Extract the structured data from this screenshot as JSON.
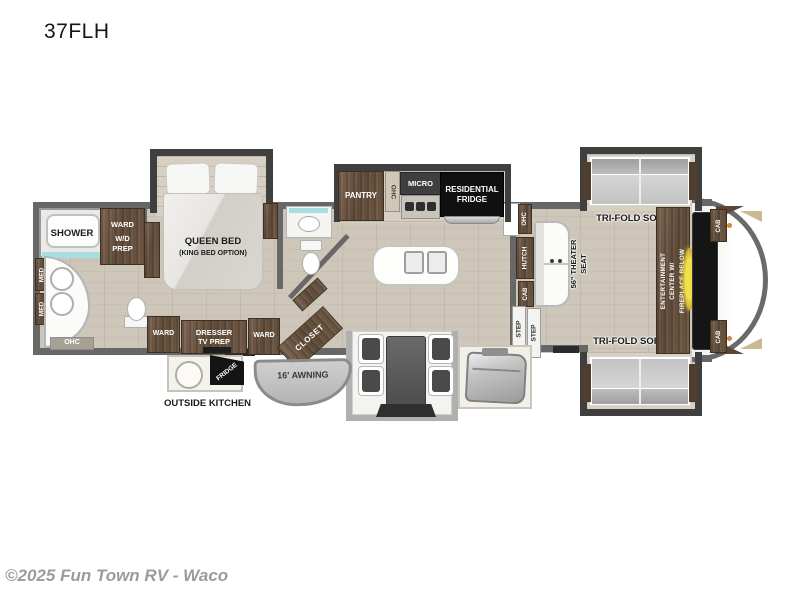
{
  "meta": {
    "title": "37FLH",
    "copyright": "©2025 Fun Town RV - Waco"
  },
  "palette": {
    "floor": "#cdc6b9",
    "wall": "#676767",
    "slide_wall": "#3f3f3f",
    "wood": "#6d5743",
    "accent_teal": "#a8dde2",
    "fireplace_glow": "#eedf4b",
    "cap_dot_orange": "#d2863a",
    "fridge_black": "#111111"
  },
  "bathroom": {
    "shower": "SHOWER",
    "ward": "WARD",
    "wd_line1": "W/D",
    "wd_line2": "PREP",
    "med_1": "MED",
    "med_2": "MED",
    "ohc": "OHC"
  },
  "bedroom": {
    "bed_line1": "QUEEN BED",
    "bed_line2": "(KING BED OPTION)",
    "ward_left": "WARD",
    "dresser_line1": "DRESSER",
    "dresser_line2": "TV PREP",
    "ward_right": "WARD"
  },
  "midbath": {
    "closet": "CLOSET"
  },
  "kitchen": {
    "pantry": "PANTRY",
    "ohc": "OHC",
    "micro": "MICRO",
    "fridge_line1": "RESIDENTIAL",
    "fridge_line2": "FRIDGE"
  },
  "exterior": {
    "outside_kitchen": "OUTSIDE KITCHEN",
    "fridge": "FRIDGE",
    "awning": "16' AWNING"
  },
  "living": {
    "ohc": "OHC",
    "hutch": "HUTCH",
    "cab": "CAB",
    "theater_line1": "56\" THEATER",
    "theater_line2": "SEAT",
    "step_1": "STEP",
    "step_2": "STEP",
    "sofa_top_label": "TRI-FOLD SOFA",
    "sofa_bottom_label": "TRI-FOLD SOFA",
    "ent_line1": "ENTERTAINMENT",
    "ent_line2": "CENTER W/",
    "ent_line3": "FIREPLACE BELOW",
    "cab_rear_top": "CAB",
    "cab_rear_bottom": "CAB"
  }
}
